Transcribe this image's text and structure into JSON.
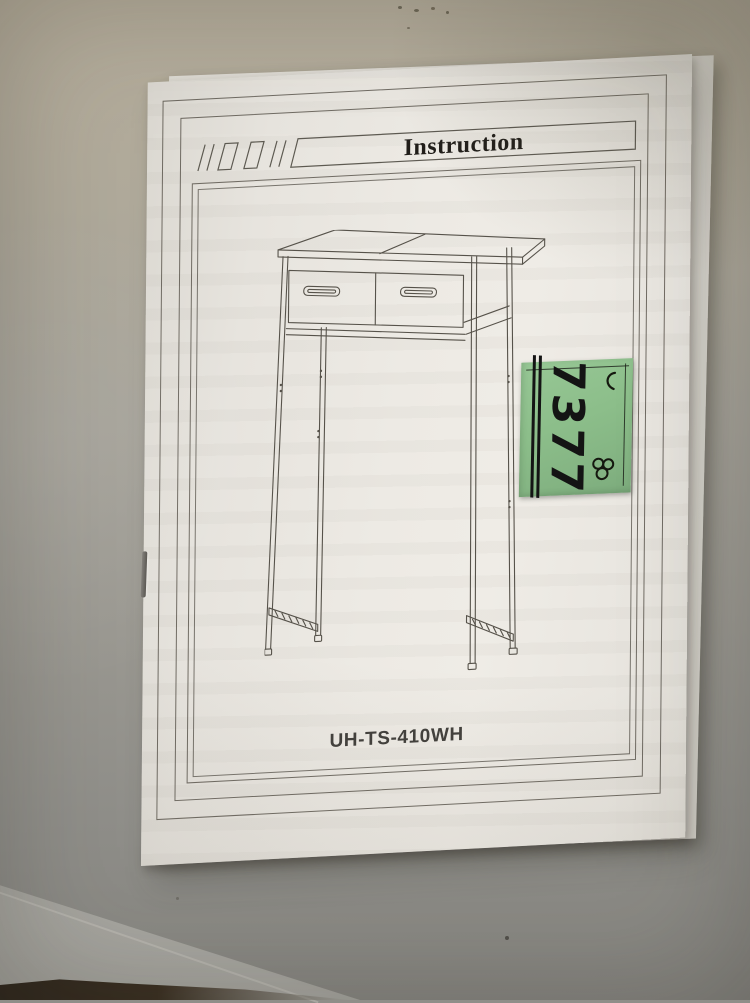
{
  "scene": {
    "desk_color": "#b2ab9a",
    "floor_color": "#8f8e89",
    "table_edge_color": "#2e261c"
  },
  "page": {
    "title": "Instruction",
    "model_number": "UH-TS-410WH",
    "paper_color": "#ebe8e2",
    "line_color": "#56524a",
    "illustration": "two-drawer-console-table"
  },
  "sticker": {
    "number": "7377",
    "green": "#8abc88",
    "ink": "#1a1a1a",
    "marks": [
      "check-mark",
      "clover-scribble"
    ]
  }
}
